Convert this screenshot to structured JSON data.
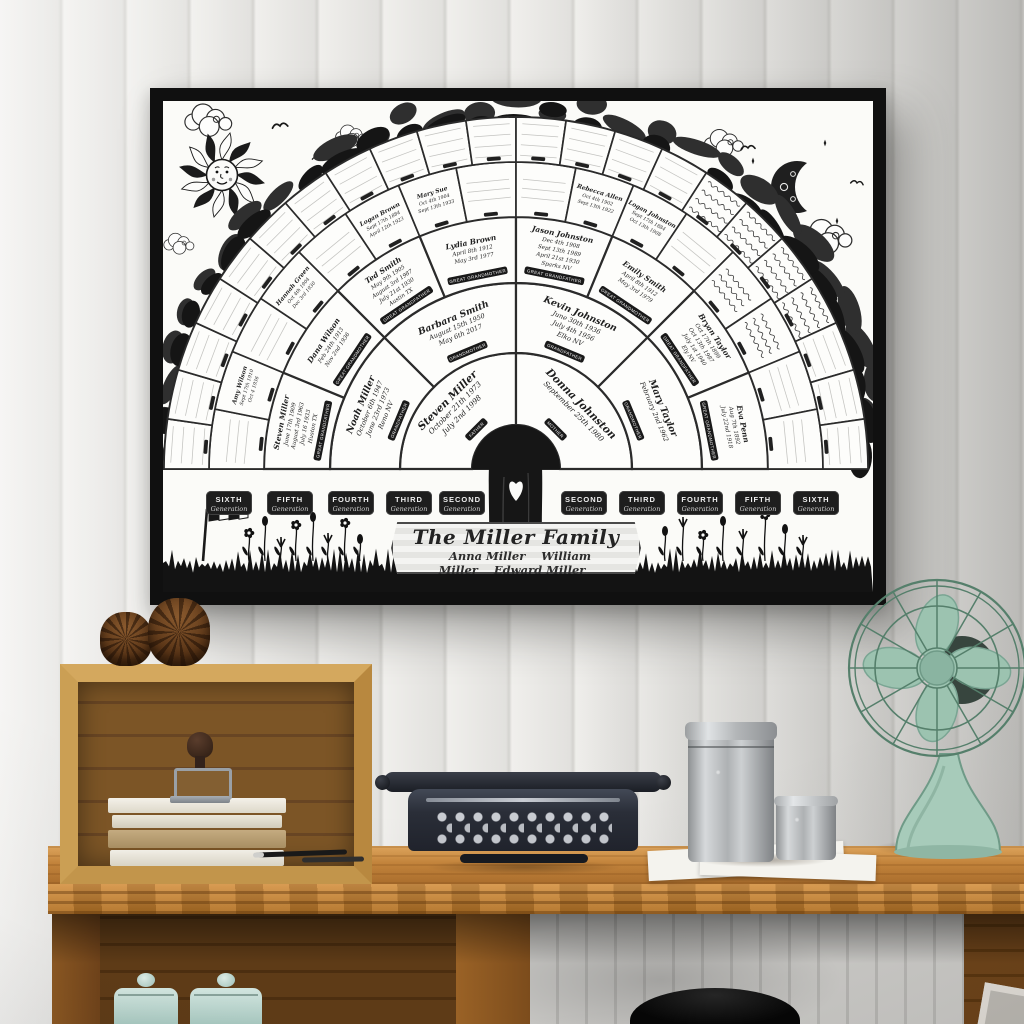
{
  "poster": {
    "title": "The Miller Family",
    "children": [
      "Anna Miller",
      "William Miller",
      "Edward Miller"
    ],
    "badge_sublabel": "Generation",
    "generation_badges_left": [
      "SIXTH",
      "FIFTH",
      "FOURTH",
      "THIRD",
      "SECOND"
    ],
    "generation_badges_right": [
      "SECOND",
      "THIRD",
      "FOURTH",
      "FIFTH",
      "SIXTH"
    ],
    "fan": {
      "type": "genealogy-fan",
      "generations": [
        {
          "label": "second",
          "sectors": [
            {
              "name": "Steven Miller",
              "dates": [
                "October 21th 1973",
                "July 2nd 1998"
              ],
              "role": "FATHER"
            },
            {
              "name": "Donna Johnston",
              "dates": [
                "September 25th 1980"
              ],
              "role": "MOTHER"
            }
          ]
        },
        {
          "label": "third",
          "sectors": [
            {
              "name": "Noah Miller",
              "dates": [
                "October 6th 1947",
                "June 23rd 1973",
                "Reno NV"
              ],
              "role": "GRANDFATHER"
            },
            {
              "name": "Barbara Smith",
              "dates": [
                "August 15th 1950",
                "May 6th 2017"
              ],
              "role": "GRANDMOTHER"
            },
            {
              "name": "Kevin Johnston",
              "dates": [
                "June 30th 1936",
                "July 4th 1956",
                "Elko NV"
              ],
              "role": "GRANDFATHER"
            },
            {
              "name": "Mary Taylor",
              "dates": [
                "February 2nd 1962"
              ],
              "role": "GRANDMOTHER"
            }
          ]
        },
        {
          "label": "fourth",
          "sectors": [
            {
              "name": "Steven Miller",
              "dates": [
                "June 17th 1909",
                "August 3rd 1963",
                "July 16 1933",
                "Huston TX"
              ],
              "role": "GREAT GRANDFATHER"
            },
            {
              "name": "Dana Wilson",
              "dates": [
                "Feb 24th 1913",
                "Nov 2nd 1936"
              ],
              "role": "GREAT GRANDMOTHER"
            },
            {
              "name": "Ted Smith",
              "dates": [
                "May 9th 1905",
                "August 3rd 1987",
                "July 21st 1930",
                "Austin TX"
              ],
              "role": "GREAT GRANDFATHER"
            },
            {
              "name": "Lydia Brown",
              "dates": [
                "April 8th 1912",
                "May 3rd 1977"
              ],
              "role": "GREAT GRANDMOTHER"
            },
            {
              "name": "Jason Johnston",
              "dates": [
                "Dec 4th 1908",
                "Sept 13th 1989",
                "April 21st 1930",
                "Sparks NV"
              ],
              "role": "GREAT GRANDFATHER"
            },
            {
              "name": "Emily Smith",
              "dates": [
                "April 8th 1912",
                "May 3rd 1979"
              ],
              "role": "GREAT GRANDMOTHER"
            },
            {
              "name": "Bryan Taylor",
              "dates": [
                "Oct 17th 1899",
                "Oct 13th 1987",
                "July 1st 1940",
                "Ely NV"
              ],
              "role": "GREAT GRANDFATHER"
            },
            {
              "name": "Eva Penn",
              "dates": [
                "Aug 7th 1892",
                "July 22nd 1918"
              ],
              "role": "GREAT GRANDMOTHER"
            }
          ]
        },
        {
          "label": "fifth",
          "sectors": [
            {
              "blank": true
            },
            {
              "name": "Amy Wilson",
              "dates": [
                "Sept 17th 1910",
                "Oct 4 1936"
              ],
              "role": "GREAT GREAT GRANDMOTHER"
            },
            {
              "blank": true
            },
            {
              "name": "Hannah Green",
              "dates": [
                "Oct 4th 1904",
                "Dec 3rd 1930"
              ],
              "role": "GREAT GREAT GRANDMOTHER"
            },
            {
              "blank": true
            },
            {
              "name": "Logan Brown",
              "dates": [
                "Sept 17th 1884",
                "April 12th 1923"
              ],
              "role": "GREAT GREAT GRANDFATHER"
            },
            {
              "name": "Mary Sue",
              "dates": [
                "Oct 4th 1904",
                "Sept 13th 1933"
              ],
              "role": "GREAT GREAT GRANDMOTHER"
            },
            {
              "blank": true
            },
            {
              "blank": true
            },
            {
              "name": "Rebecca Allen",
              "dates": [
                "Oct 4th 1902",
                "Sept 13th 1922"
              ],
              "role": "GREAT GREAT GRANDMOTHER"
            },
            {
              "name": "Logan Johnston",
              "dates": [
                "Sept 17th 1884",
                "Oct 13th 1908"
              ],
              "role": "GREAT GREAT GRANDFATHER"
            },
            {
              "blank": true
            },
            {
              "scribble": true
            },
            {
              "scribble": true
            },
            {
              "blank": true
            },
            {
              "blank": true
            }
          ]
        },
        {
          "label": "sixth",
          "sectors": [
            {
              "blank": true
            },
            {
              "blank": true
            },
            {
              "blank": true
            },
            {
              "blank": true
            },
            {
              "blank": true
            },
            {
              "blank": true
            },
            {
              "blank": true
            },
            {
              "blank": true
            },
            {
              "blank": true
            },
            {
              "blank": true
            },
            {
              "blank": true
            },
            {
              "blank": true
            },
            {
              "blank": true
            },
            {
              "blank": true
            },
            {
              "blank": true
            },
            {
              "scribble": true
            },
            {
              "scribble": true
            },
            {
              "scribble": true
            },
            {
              "scribble": true
            },
            {
              "blank": true
            },
            {
              "blank": true
            },
            {
              "blank": true
            }
          ]
        }
      ]
    }
  },
  "colors": {
    "frame": "#101010",
    "poster_paper": "#fbfbf8",
    "ink": "#1d1d1d",
    "wall_plank": "#e7e6e3",
    "desk_wood": "#bc7f39",
    "appliance_fan_mint": "#a3c8b5",
    "jar_mint": "#bcd8d1",
    "typewriter_body": "#262a33",
    "canister_steel": "#b8bbbd"
  }
}
